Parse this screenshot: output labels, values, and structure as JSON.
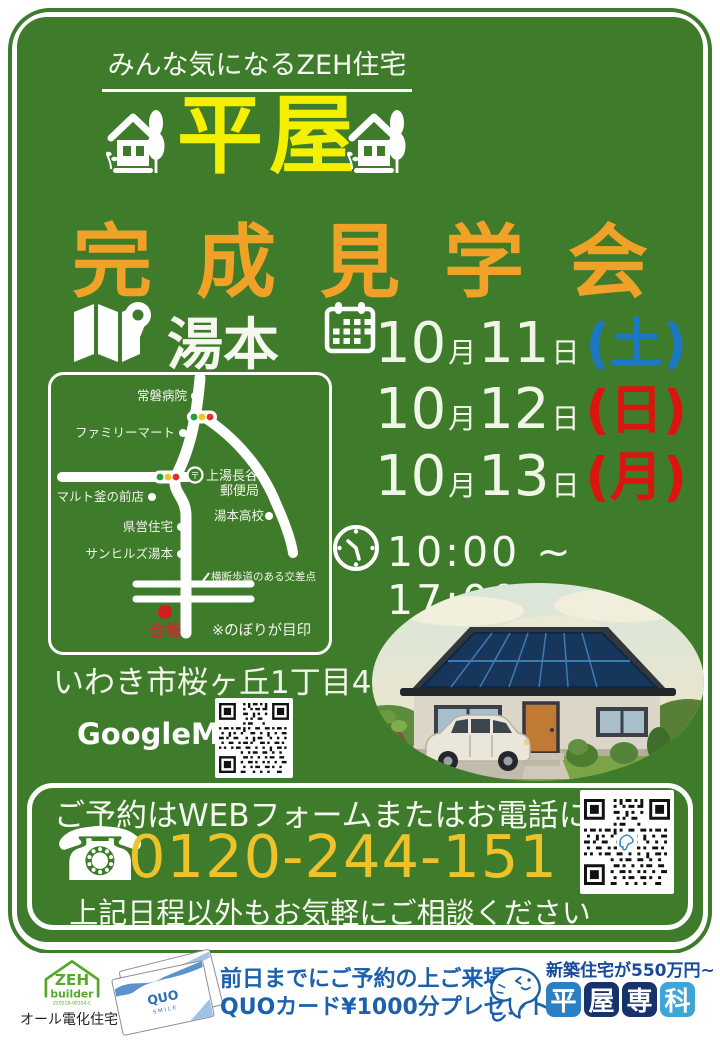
{
  "colors": {
    "panel_green": "#3e7c2b",
    "title_yellow": "#f3f000",
    "subtitle_orange": "#f0a228",
    "saturday_blue": "#1b78c5",
    "sunday_red": "#dc1410",
    "phone_gold": "#eec32a",
    "venue_red": "#c62222",
    "footer_blue": "#1b61ae",
    "brand_navy": "#16336b",
    "brand_blue": "#2b7fc2",
    "brand_lightblue": "#3fa4d8",
    "zeh_green": "#56a829"
  },
  "icons": {
    "map": "folded-map-with-pin",
    "calendar": "calendar-grid",
    "clock": "clock-outline",
    "phone": "☎",
    "house": "house-with-poplar-tree",
    "qr": "qr-code"
  },
  "header": {
    "tagline": "みんな気になるZEH住宅",
    "title": "平屋",
    "subtitle": "完成見学会"
  },
  "event": {
    "location": "湯本",
    "time": "10:00 ~ 17:00",
    "dates": [
      {
        "num1": "10",
        "unit1": "月",
        "num2": "11",
        "unit2": "日",
        "dow": "(土)",
        "dow_color": "#1b78c5"
      },
      {
        "num1": "10",
        "unit1": "月",
        "num2": "12",
        "unit2": "日",
        "dow": "(日)",
        "dow_color": "#dc1410"
      },
      {
        "num1": "10",
        "unit1": "月",
        "num2": "13",
        "unit2": "日",
        "dow": "(月)",
        "dow_color": "#dc1410"
      }
    ]
  },
  "map": {
    "hospital": "常磐病院",
    "conveni": "ファミリーマート",
    "shop": "マルト釜の前店",
    "housing": "県営住宅",
    "sunhills": "サンヒルズ湯本",
    "school": "湯本高校",
    "postmark": "〒",
    "post1": "上湯長谷",
    "post2": "郵便局",
    "crossing": "横断歩道のある交差点",
    "venue": "会場",
    "note": "※のぼりが目印"
  },
  "address": "いわき市桜ヶ丘1丁目47",
  "googlemap_label": "GoogleMap",
  "reservation": {
    "line1": "ご予約はWEBフォームまたはお電話にて",
    "phone": "0120-244-151",
    "line2": "上記日程以外もお気軽にご相談ください"
  },
  "footer": {
    "zeh_line1": "ZEH",
    "zeh_line2": "builder",
    "zeh_cert": "Z2021B-00354-C",
    "zeh_sub": "オール電化住宅",
    "quo": "QUO",
    "quo_sub": "SMILE",
    "promo1": "前日までにご予約の上ご来場で",
    "promo2": "QUOカード¥1000分プレゼント",
    "ribbon": "新築住宅が550万円~",
    "brand": [
      "平",
      "屋",
      "専",
      "科"
    ]
  }
}
